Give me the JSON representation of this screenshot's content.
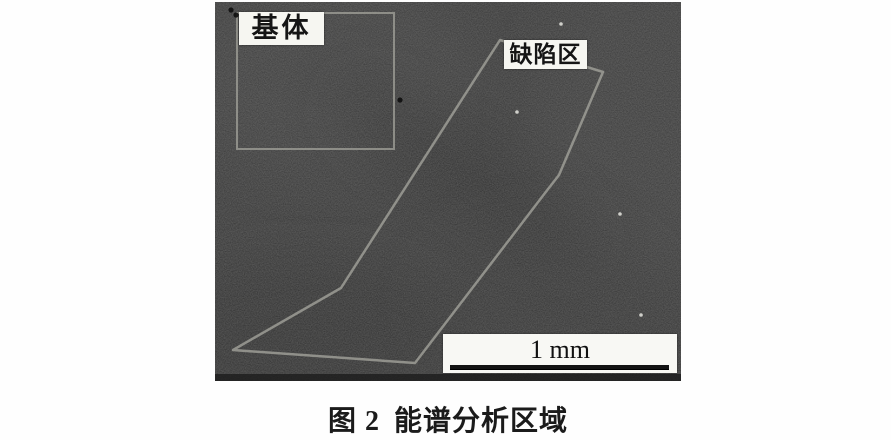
{
  "figure": {
    "labels": {
      "matrix": "基体",
      "defect": "缺陷区"
    },
    "scale_bar": {
      "text": "1 mm"
    },
    "caption": {
      "prefix": "图 2",
      "title": "能谱分析区域"
    },
    "colors": {
      "page_bg": "#fefefe",
      "micrograph_bg": "#3e3e3e",
      "outline": "#a3a39b",
      "label_bg": "#f6f6f1",
      "label_text": "#151515",
      "scalebar_bg": "#f8f8f4",
      "scalebar_line": "#131313",
      "caption_text": "#1b1b1b"
    },
    "regions": {
      "matrix_box": {
        "x": 22,
        "y": 11,
        "w": 157,
        "h": 136
      },
      "defect_polygon": [
        [
          285,
          38
        ],
        [
          388,
          70
        ],
        [
          344,
          173
        ],
        [
          330,
          191
        ],
        [
          200,
          361
        ],
        [
          18,
          348
        ],
        [
          126,
          286
        ]
      ]
    },
    "specks": {
      "bright": [
        [
          302,
          110
        ],
        [
          405,
          212
        ],
        [
          426,
          313
        ],
        [
          346,
          22
        ]
      ],
      "dark": [
        [
          185,
          98
        ],
        [
          16,
          8
        ],
        [
          21,
          13
        ]
      ]
    }
  }
}
